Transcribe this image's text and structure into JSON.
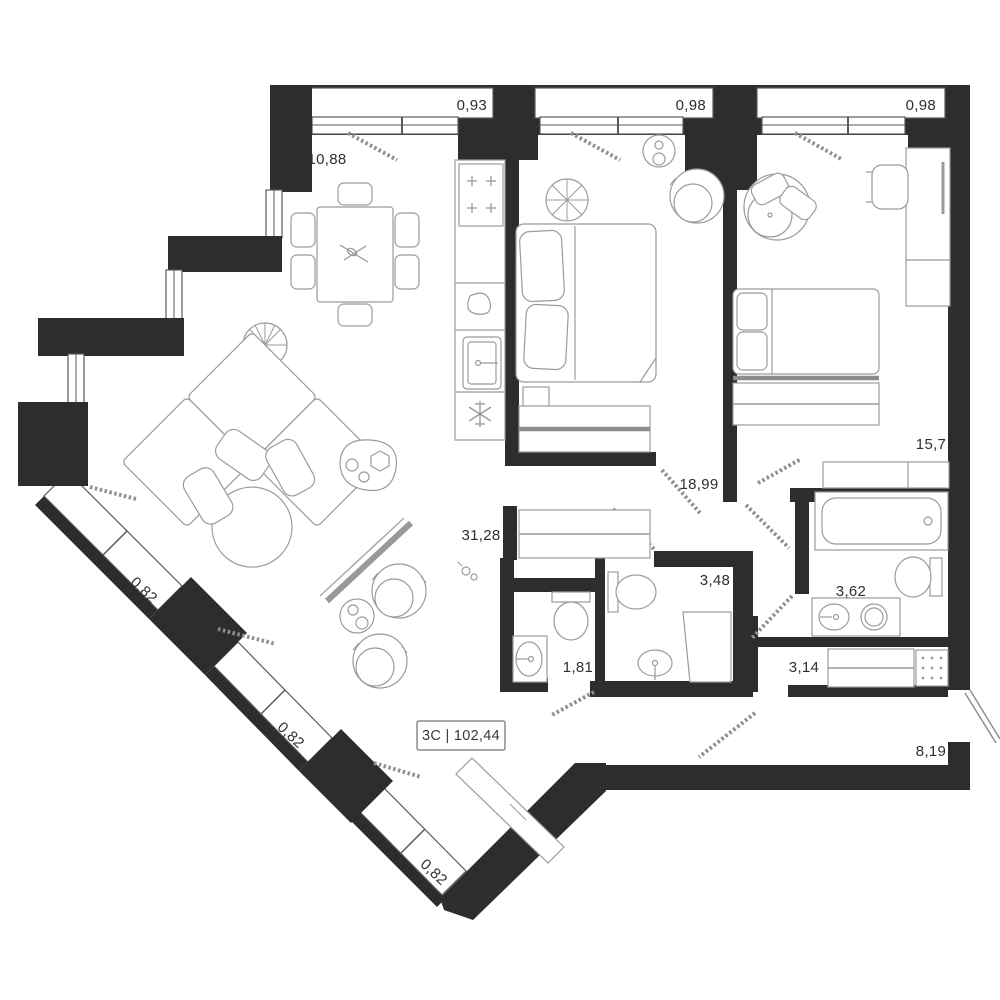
{
  "plan": {
    "tag": {
      "label": "3С | 102,44"
    },
    "rooms": {
      "dining_kitchen": {
        "area": "10,88"
      },
      "living": {
        "area": "31,28"
      },
      "corridor": {
        "area": "18,99"
      },
      "bedroom_right": {
        "area": "15,7"
      },
      "bath_small": {
        "area": "3,48"
      },
      "bath_large": {
        "area": "3,62"
      },
      "wc": {
        "area": "1,81"
      },
      "closet_room": {
        "area": "3,14"
      },
      "hallway": {
        "area": "8,19"
      }
    },
    "balconies": {
      "top_left": {
        "area": "0,93"
      },
      "top_mid": {
        "area": "0,98"
      },
      "top_right": {
        "area": "0,98"
      },
      "diag_1": {
        "area": "0,82"
      },
      "diag_2": {
        "area": "0,82"
      },
      "diag_3": {
        "area": "0,82"
      }
    },
    "colors": {
      "wall": "#2d2d2d",
      "furniture": "#9b9b9b",
      "background": "#ffffff",
      "label": "#2f2f2f"
    }
  }
}
